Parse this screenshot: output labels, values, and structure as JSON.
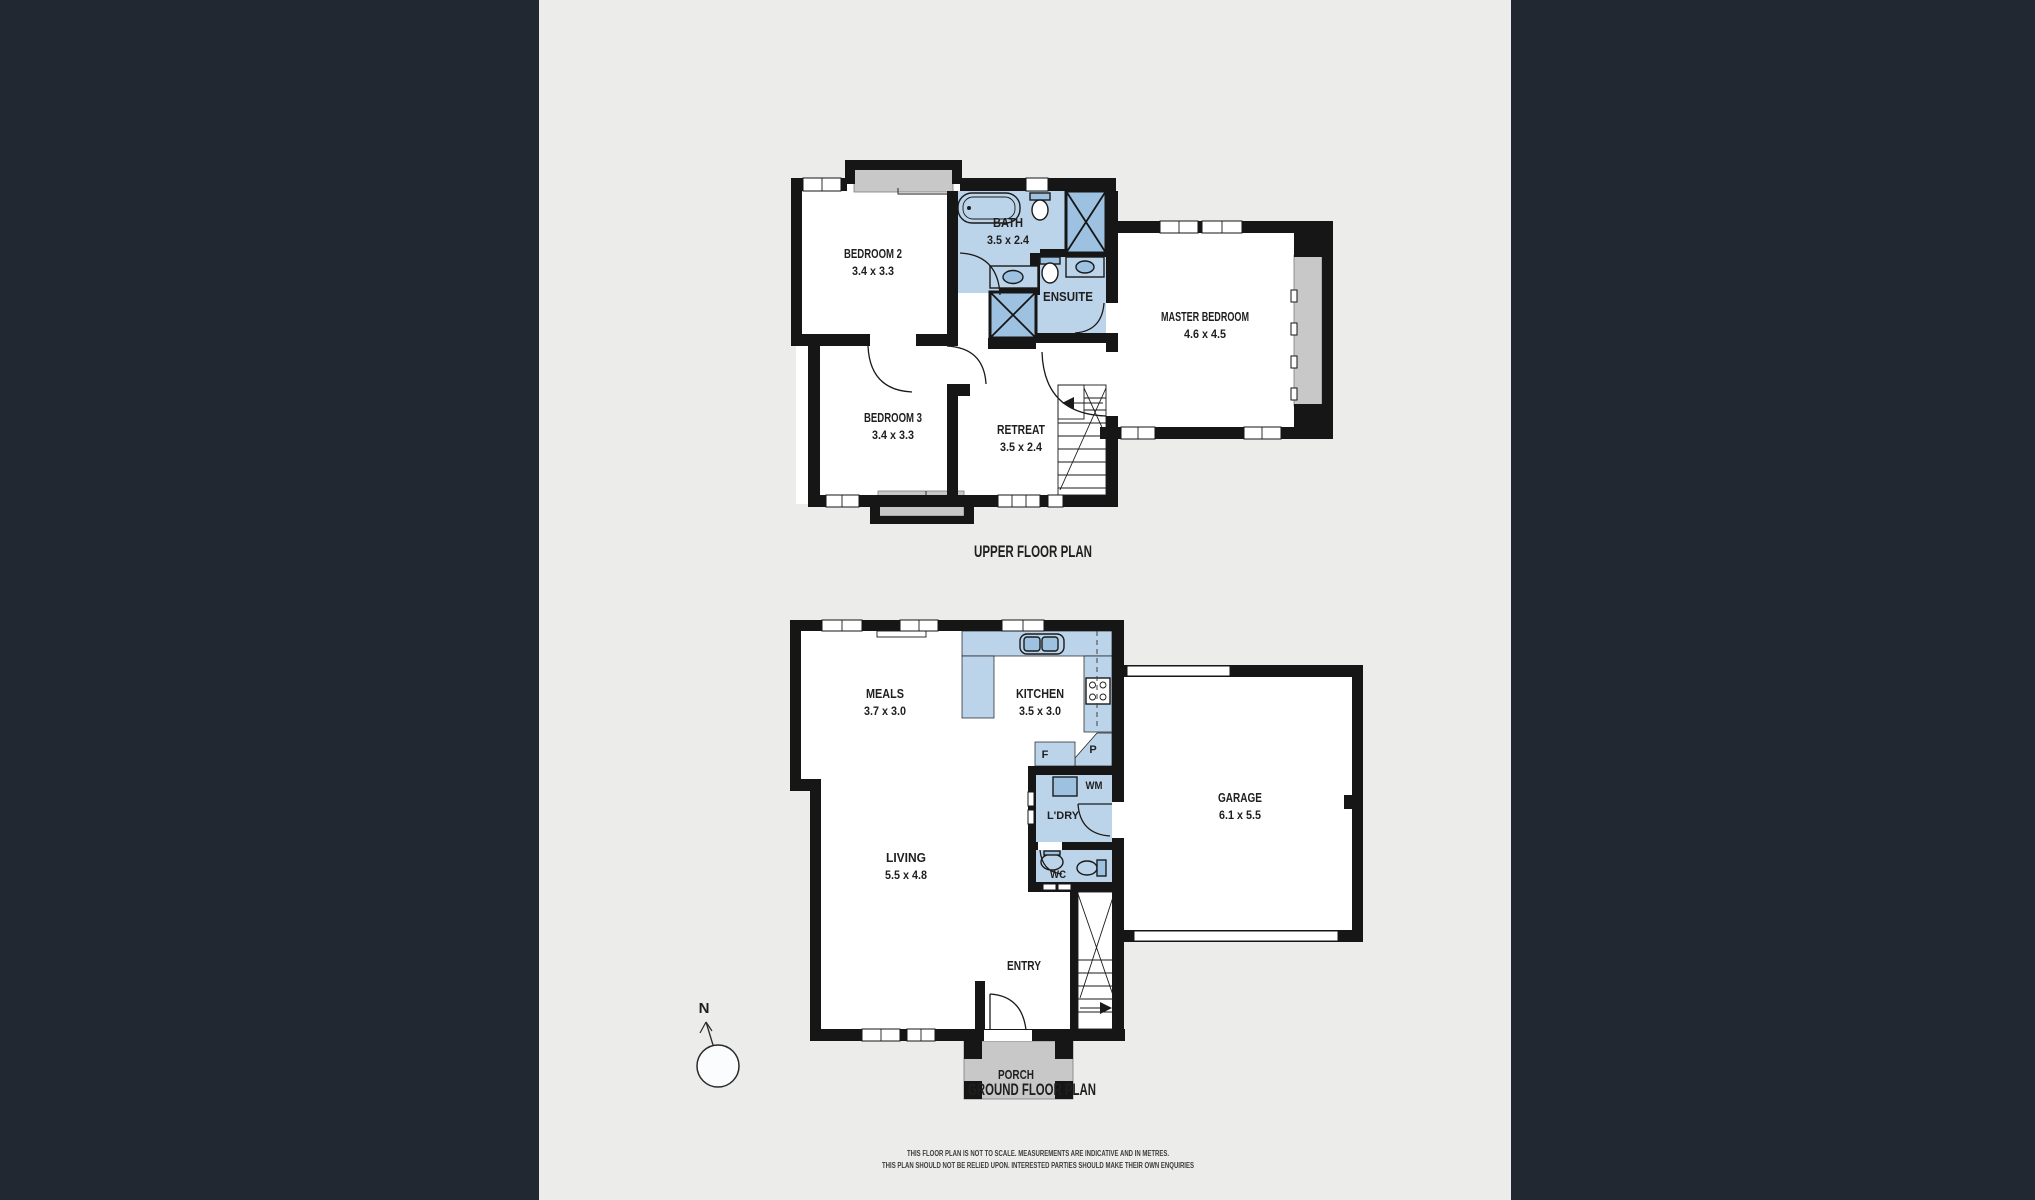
{
  "palette": {
    "backdrop": "#222831",
    "panel": "#ECECEB",
    "wall": "#161616",
    "room": "#FFFFFF",
    "wet_area": "#BCD4EA",
    "fixture_blue": "#9DC1E0",
    "ledge_gray": "#C8C8C8",
    "text": "#1F1F1F"
  },
  "upper": {
    "title": "UPPER FLOOR PLAN",
    "bedroom2": {
      "name": "BEDROOM 2",
      "dims": "3.4 x 3.3"
    },
    "bath": {
      "name": "BATH",
      "dims": "3.5 x 2.4"
    },
    "ensuite": {
      "name": "ENSUITE"
    },
    "master": {
      "name": "MASTER BEDROOM",
      "dims": "4.6 x 4.5"
    },
    "bedroom3": {
      "name": "BEDROOM 3",
      "dims": "3.4 x 3.3"
    },
    "retreat": {
      "name": "RETREAT",
      "dims": "3.5 x 2.4"
    }
  },
  "ground": {
    "title": "GROUND FLOOR PLAN",
    "meals": {
      "name": "MEALS",
      "dims": "3.7 x 3.0"
    },
    "kitchen": {
      "name": "KITCHEN",
      "dims": "3.5 x 3.0"
    },
    "living": {
      "name": "LIVING",
      "dims": "5.5 x 4.8"
    },
    "garage": {
      "name": "GARAGE",
      "dims": "6.1 x 5.5"
    },
    "entry": {
      "name": "ENTRY"
    },
    "porch": {
      "name": "PORCH"
    },
    "laundry": {
      "name": "L'DRY"
    },
    "wc": {
      "name": "WC"
    },
    "fridge": {
      "name": "F"
    },
    "pantry": {
      "name": "P"
    },
    "washer": {
      "name": "WM"
    }
  },
  "compass": {
    "north": "N"
  },
  "disclaimer": {
    "line1": "THIS FLOOR PLAN IS NOT TO SCALE. MEASUREMENTS ARE INDICATIVE AND IN METRES.",
    "line2": "THIS PLAN SHOULD NOT BE RELIED UPON.  INTERESTED PARTIES SHOULD MAKE THEIR OWN ENQUIRIES"
  }
}
